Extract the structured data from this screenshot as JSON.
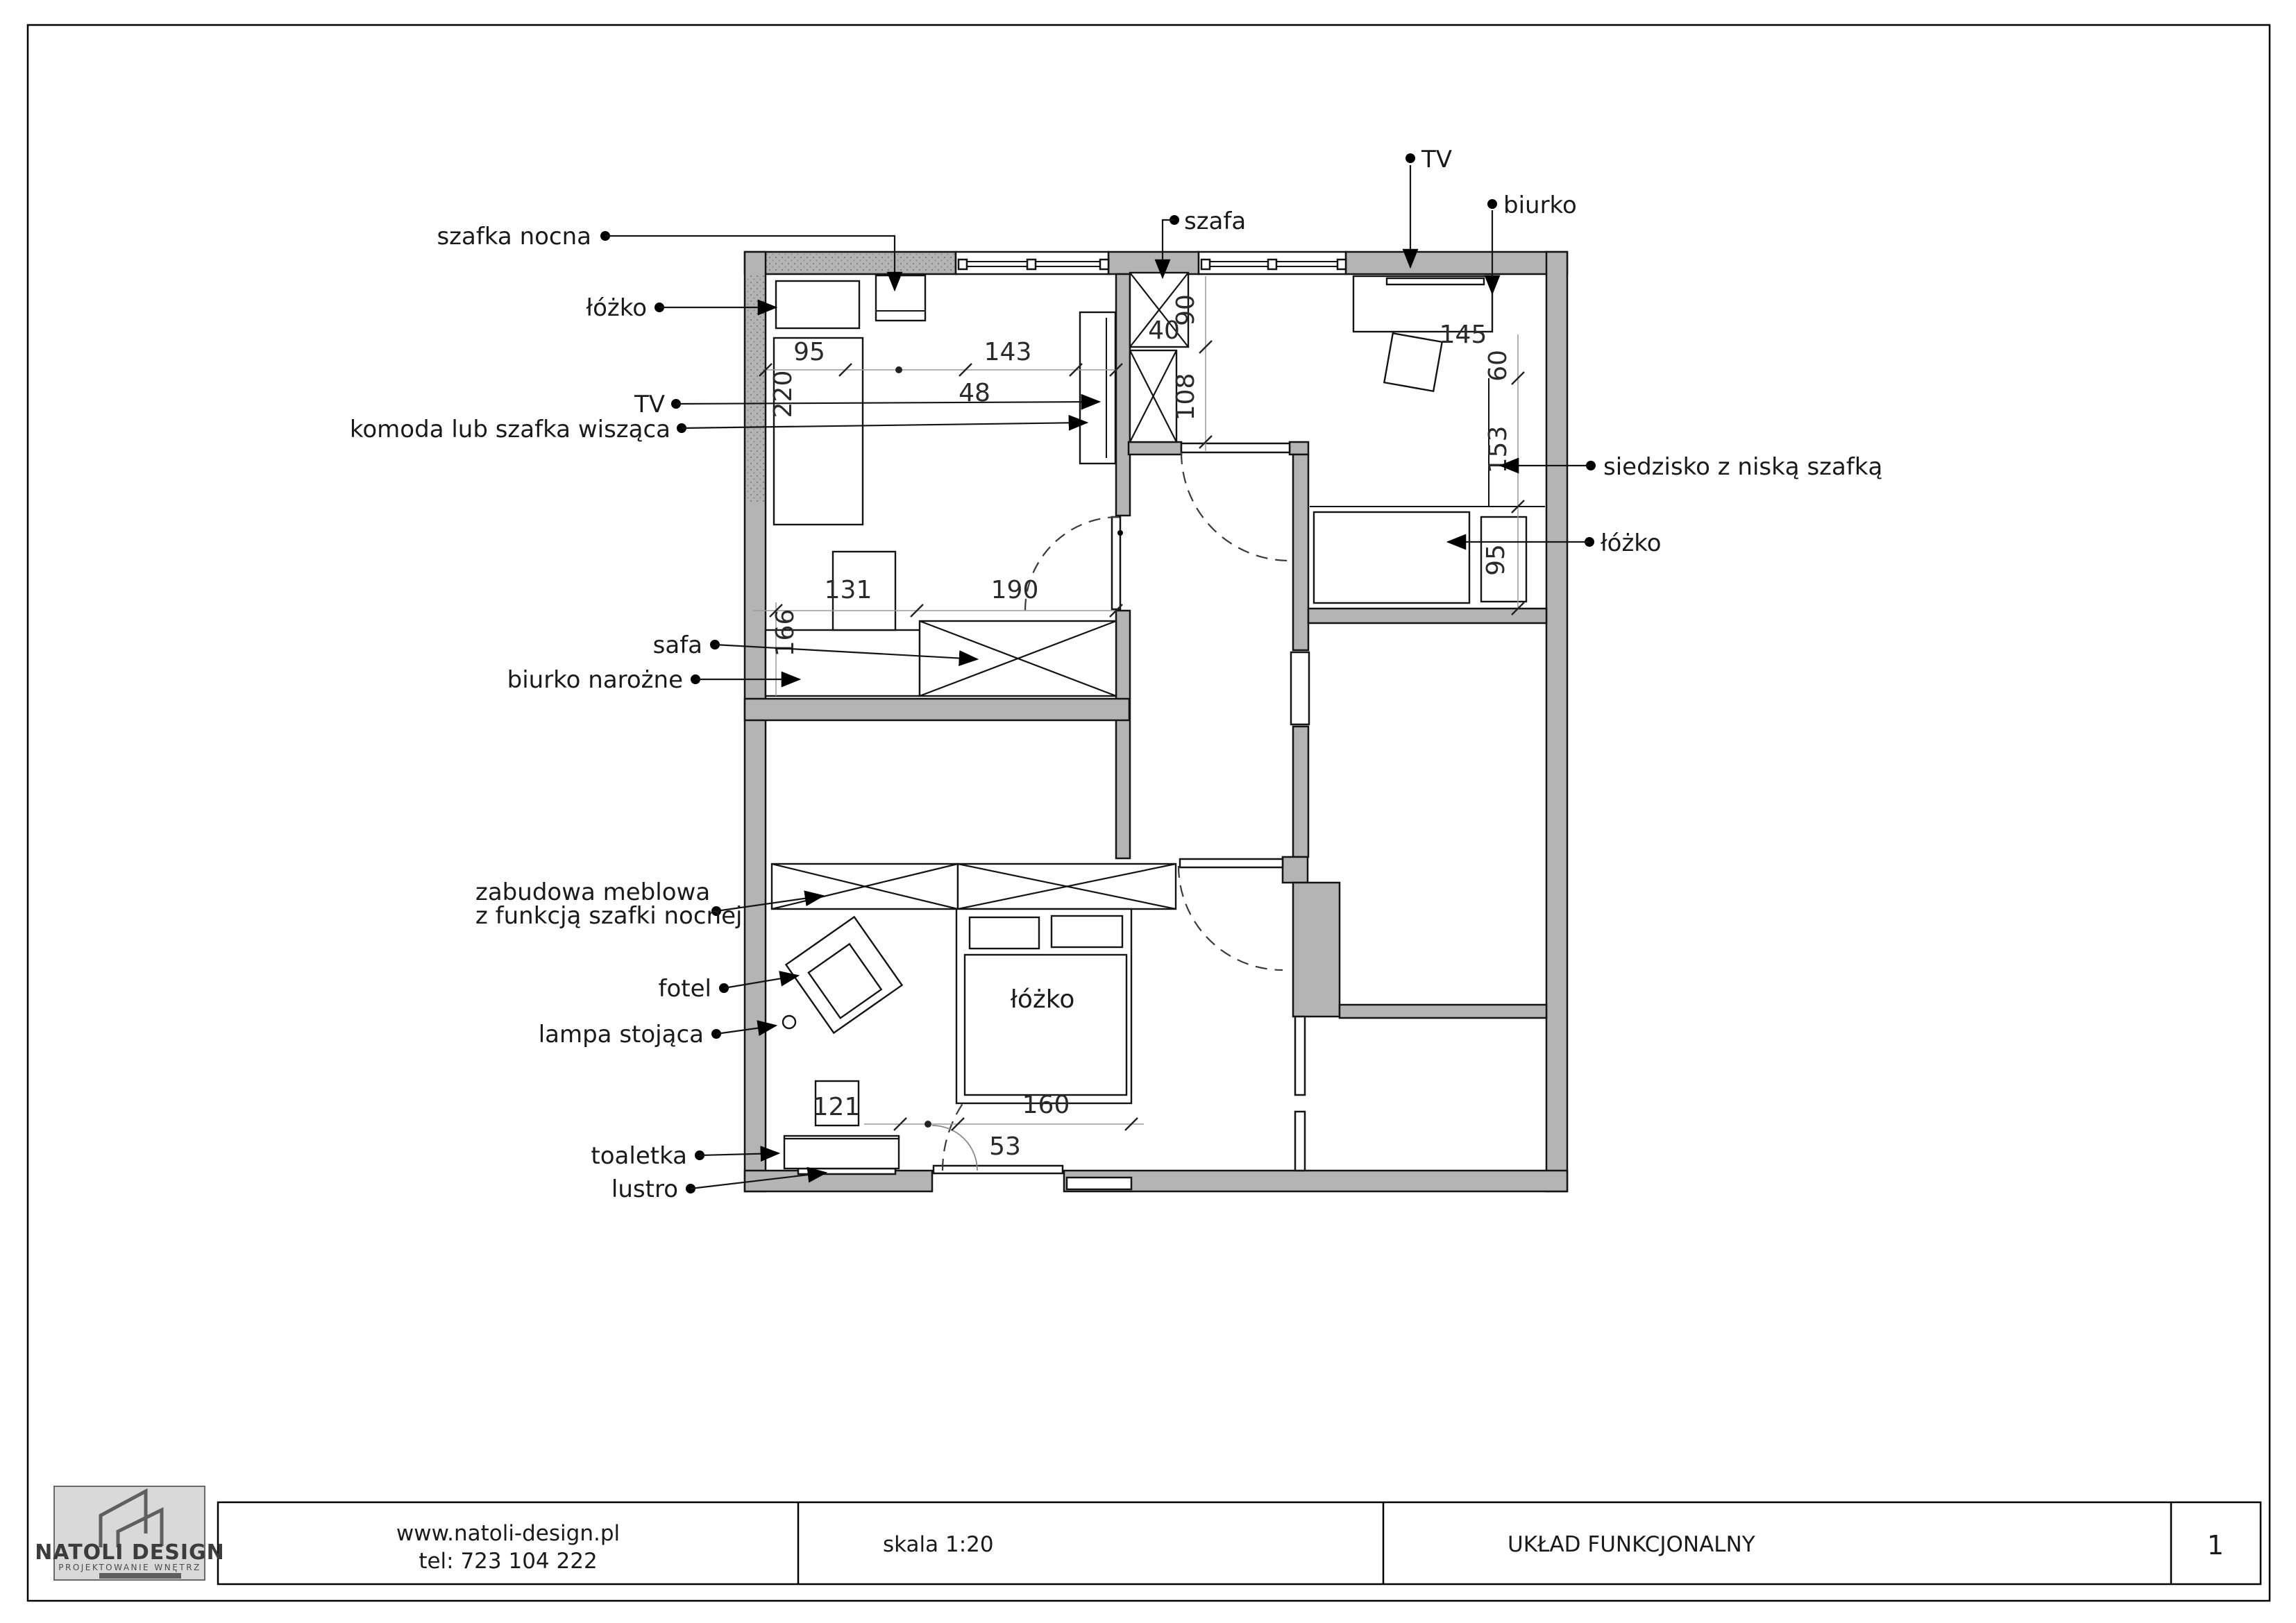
{
  "title_block": {
    "company": "NATOLI DESIGN",
    "company_sub": "PROJEKTOWANIE WNĘTRZ",
    "url": "www.natoli-design.pl",
    "tel": "tel: 723 104 222",
    "scale": "skala 1:20",
    "drawing_title": "UKŁAD FUNKCJONALNY",
    "page": "1"
  },
  "colors": {
    "wall_gray": "#b4b4b4",
    "line_black": "#141414",
    "logo_bg": "#d9d9d9"
  },
  "labels": {
    "left": {
      "szafka_nocna": "szafka nocna",
      "lozko1": "łóżko",
      "tv": "TV",
      "komoda": "komoda lub szafka wisząca",
      "safa": "safa",
      "biurko_narozne": "biurko narożne",
      "zabudowa_1": "zabudowa meblowa",
      "zabudowa_2": "z funkcją szafki nocnej",
      "fotel": "fotel",
      "lampa": "lampa stojąca",
      "toaletka": "toaletka",
      "lustro": "lustro"
    },
    "top": {
      "szafa": "szafa",
      "tv": "TV",
      "biurko": "biurko"
    },
    "right": {
      "siedzisko": "siedzisko z niską szafką",
      "lozko3": "łóżko"
    },
    "rooms": {
      "bed2": "łóżko"
    }
  },
  "dims": {
    "bed1_width": "95",
    "seg_143": "143",
    "tv_cab_48": "48",
    "bed1_len_220": "220",
    "col_40": "40",
    "col_90": "90",
    "col_108": "108",
    "desk_145": "145",
    "niche_60": "60",
    "niche_153": "153",
    "bed3_95": "95",
    "left_166": "166",
    "seg_131": "131",
    "safa_190": "190",
    "stool_121": "121",
    "bed2_160": "160",
    "gap_53": "53"
  }
}
